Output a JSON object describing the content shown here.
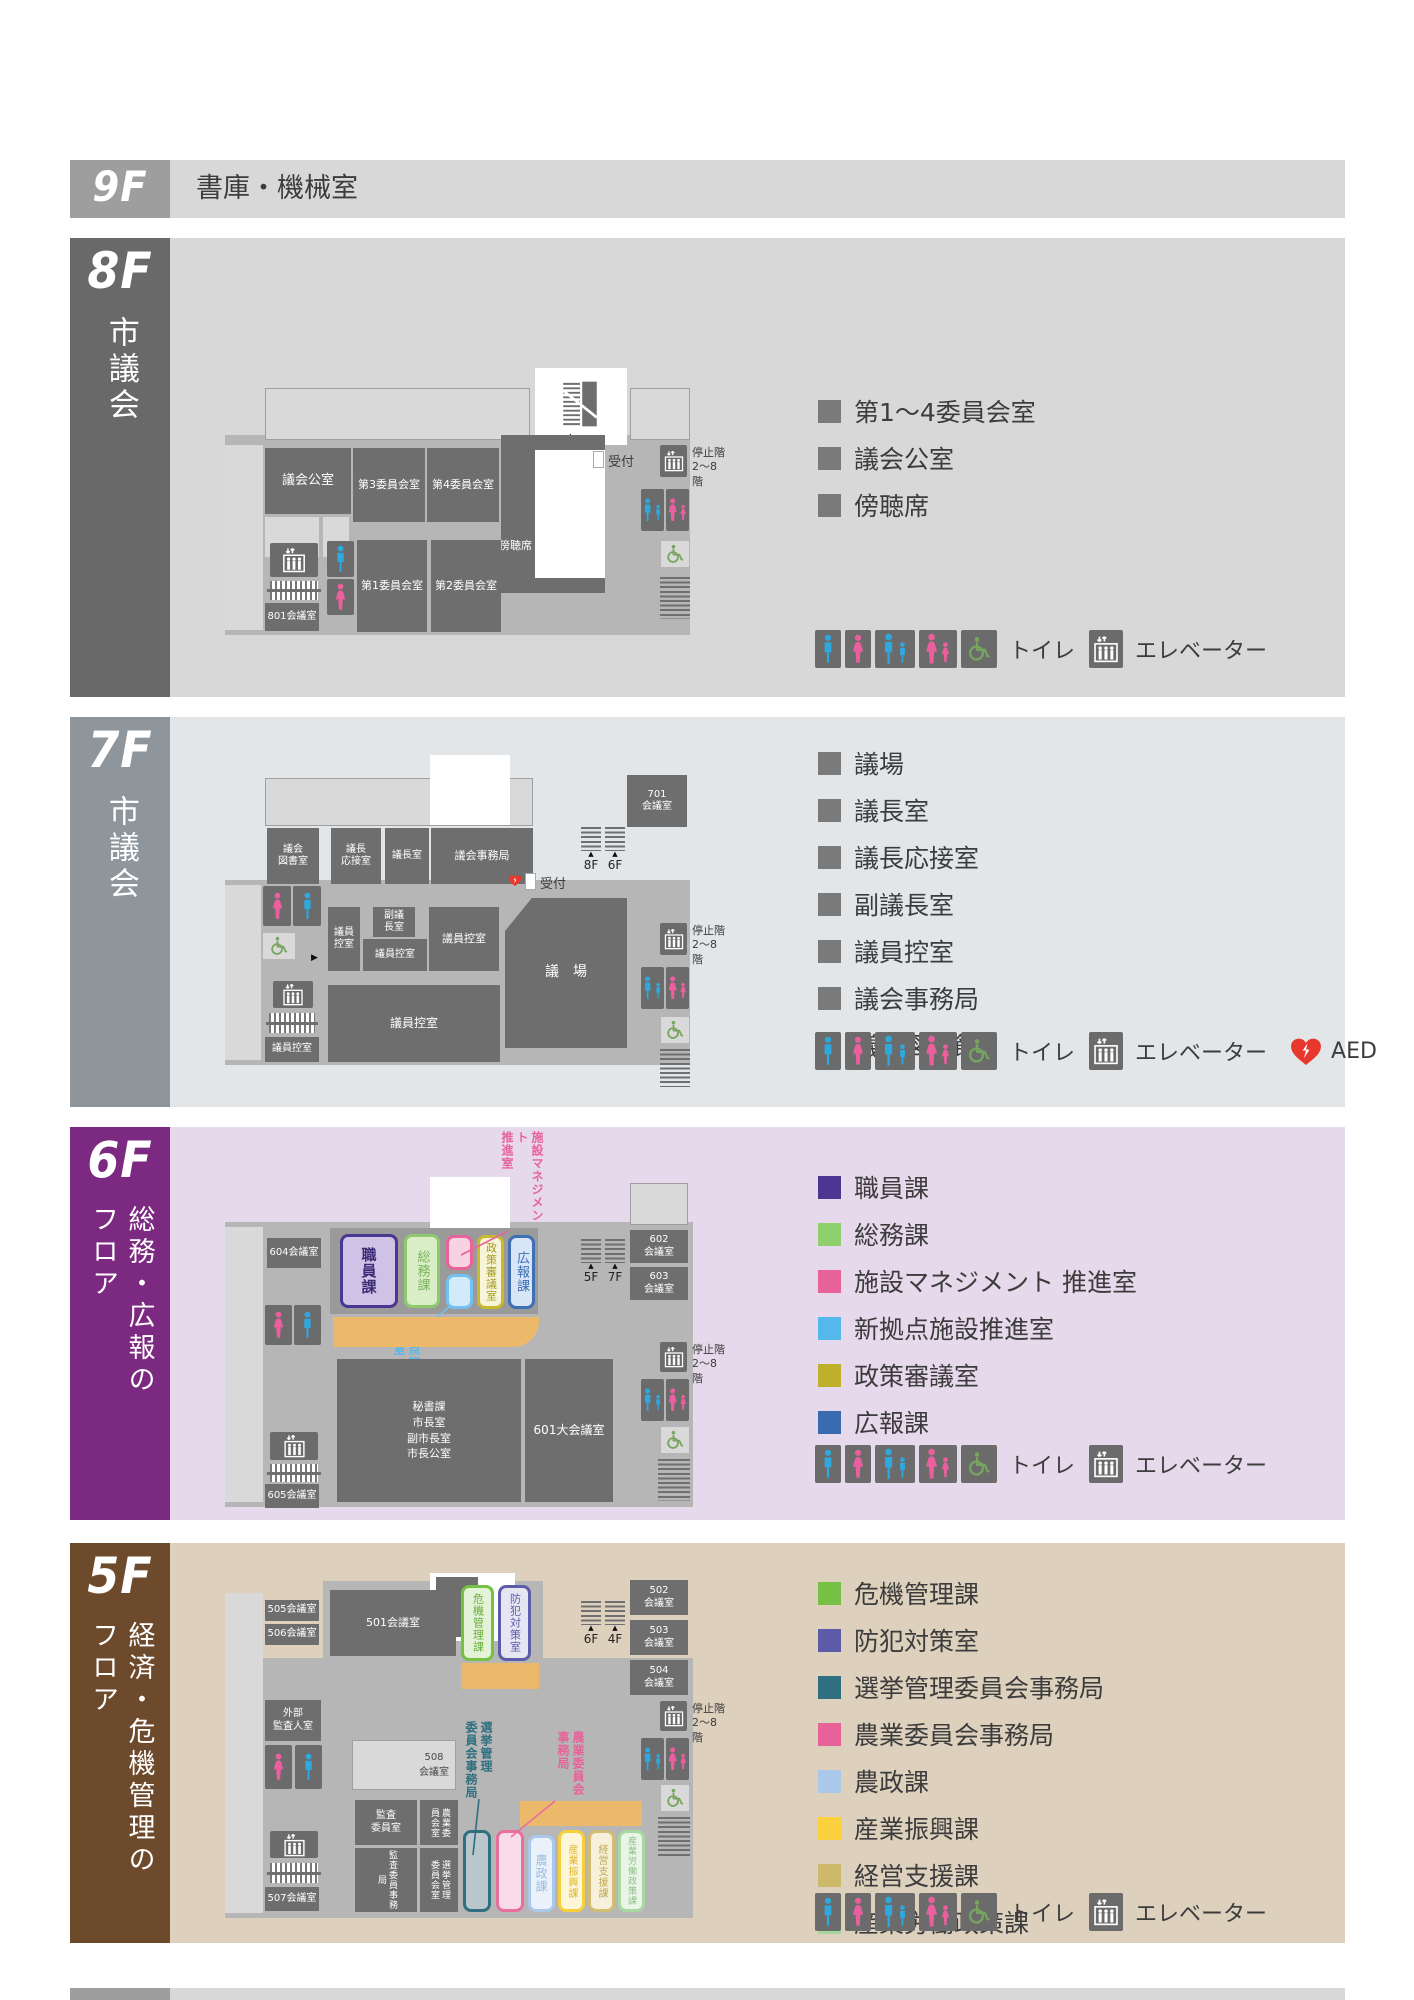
{
  "c": {
    "toilet": "トイレ",
    "elevator": "エレベーター",
    "aed": "AED",
    "reception": "受付",
    "stop": "停止階\n2〜8階"
  },
  "f9": {
    "label": "9F",
    "title": "書庫・機械室"
  },
  "f8": {
    "label": "8F",
    "side": "市議会",
    "legend": [
      {
        "t": "第1〜4委員会室"
      },
      {
        "t": "議会公室"
      },
      {
        "t": "傍聴席"
      }
    ],
    "rooms": {
      "gikai_koshitsu": "議会公室",
      "dai3": "第3委員会室",
      "dai4": "第4委員会室",
      "dai1": "第1委員会室",
      "dai2": "第2委員会室",
      "r801": "801会議室",
      "bochoseki": "傍聴席",
      "stairs_to": "7F"
    }
  },
  "f7": {
    "label": "7F",
    "side": "市議会",
    "legend": [
      {
        "t": "議場"
      },
      {
        "t": "議長室"
      },
      {
        "t": "議長応接室"
      },
      {
        "t": "副議長室"
      },
      {
        "t": "議員控室"
      },
      {
        "t": "議会事務局"
      },
      {
        "t": "議会図書館"
      }
    ],
    "rooms": {
      "tosho": "議会\n図書室",
      "osetsu": "議長\n応接室",
      "gicho": "議長室",
      "jimukyoku": "議会事務局",
      "r701": "701\n会議室",
      "fukugicho": "副議\n長室",
      "hikae_a": "議員\n控室",
      "hikae_b": "議員控室",
      "hikae_c": "議員控室",
      "hikae_d": "議員控室",
      "hikae_e": "議員控室",
      "gijo": "議　場",
      "stairs_up": "8F",
      "stairs_down": "6F"
    }
  },
  "f6": {
    "label": "6F",
    "side": "総務・広報の\nフロア",
    "legend": [
      {
        "c": "#4b3792",
        "t": "職員課"
      },
      {
        "c": "#8ed06c",
        "t": "総務課"
      },
      {
        "c": "#e8639a",
        "t": "施設マネジメント 推進室"
      },
      {
        "c": "#54b8ea",
        "t": "新拠点施設推進室"
      },
      {
        "c": "#bfb02c",
        "t": "政策審議室"
      },
      {
        "c": "#3a6ab0",
        "t": "広報課"
      }
    ],
    "rooms": {
      "r604": "604会議室",
      "r602": "602\n会議室",
      "r603": "603\n会議室",
      "r605": "605会議室",
      "shokuin": "職員課",
      "somu": "総務課",
      "seisaku": "政策審議室",
      "koho": "広報課",
      "callout_shisetsu": "施設マネジメント\n推進室",
      "callout_shinkyoten": "新拠点施設\n推進室",
      "hisho": "秘書課\n市長室\n副市長室\n市長公室",
      "r601": "601大会議室",
      "stairs_down": "5F",
      "stairs_up": "7F"
    }
  },
  "f5": {
    "label": "5F",
    "side": "経済・危機管理の\nフロア",
    "legend": [
      {
        "c": "#76c043",
        "t": "危機管理課"
      },
      {
        "c": "#5c5ca8",
        "t": "防犯対策室"
      },
      {
        "c": "#2f6f80",
        "t": "選挙管理委員会事務局"
      },
      {
        "c": "#e8639a",
        "t": "農業委員会事務局"
      },
      {
        "c": "#aac8ea",
        "t": "農政課"
      },
      {
        "c": "#fcd13e",
        "t": "産業振興課"
      },
      {
        "c": "#cdb96a",
        "t": "経営支援課"
      },
      {
        "c": "#a5d6a0",
        "t": "産業労働政策課"
      }
    ],
    "rooms": {
      "r505": "505会議室",
      "r506": "506会議室",
      "gaibu": "外部\n監査人室",
      "r501": "501会議室",
      "r508": "508\n会議室",
      "kiki": "危機管理課",
      "bohan": "防犯対策室",
      "r502": "502\n会議室",
      "r503": "503\n会議室",
      "r504": "504\n会議室",
      "kansa_iin": "監査\n委員室",
      "nogyo_shitsu": "農業委\n員会室",
      "kansa_jimu": "監査委員事務局",
      "senkyo_shitsu": "選挙管理\n委員会室",
      "r507": "507会議室",
      "nosei": "農政課",
      "sangyo_shinko": "産業振興課",
      "keiei": "経営支援課",
      "sangyo_rodo": "産業労働政策課",
      "callout_senkyo": "選挙管理\n委員会事務局",
      "callout_nogyo": "農業委員会\n事務局",
      "stairs_up": "6F",
      "stairs_down": "4F"
    }
  }
}
